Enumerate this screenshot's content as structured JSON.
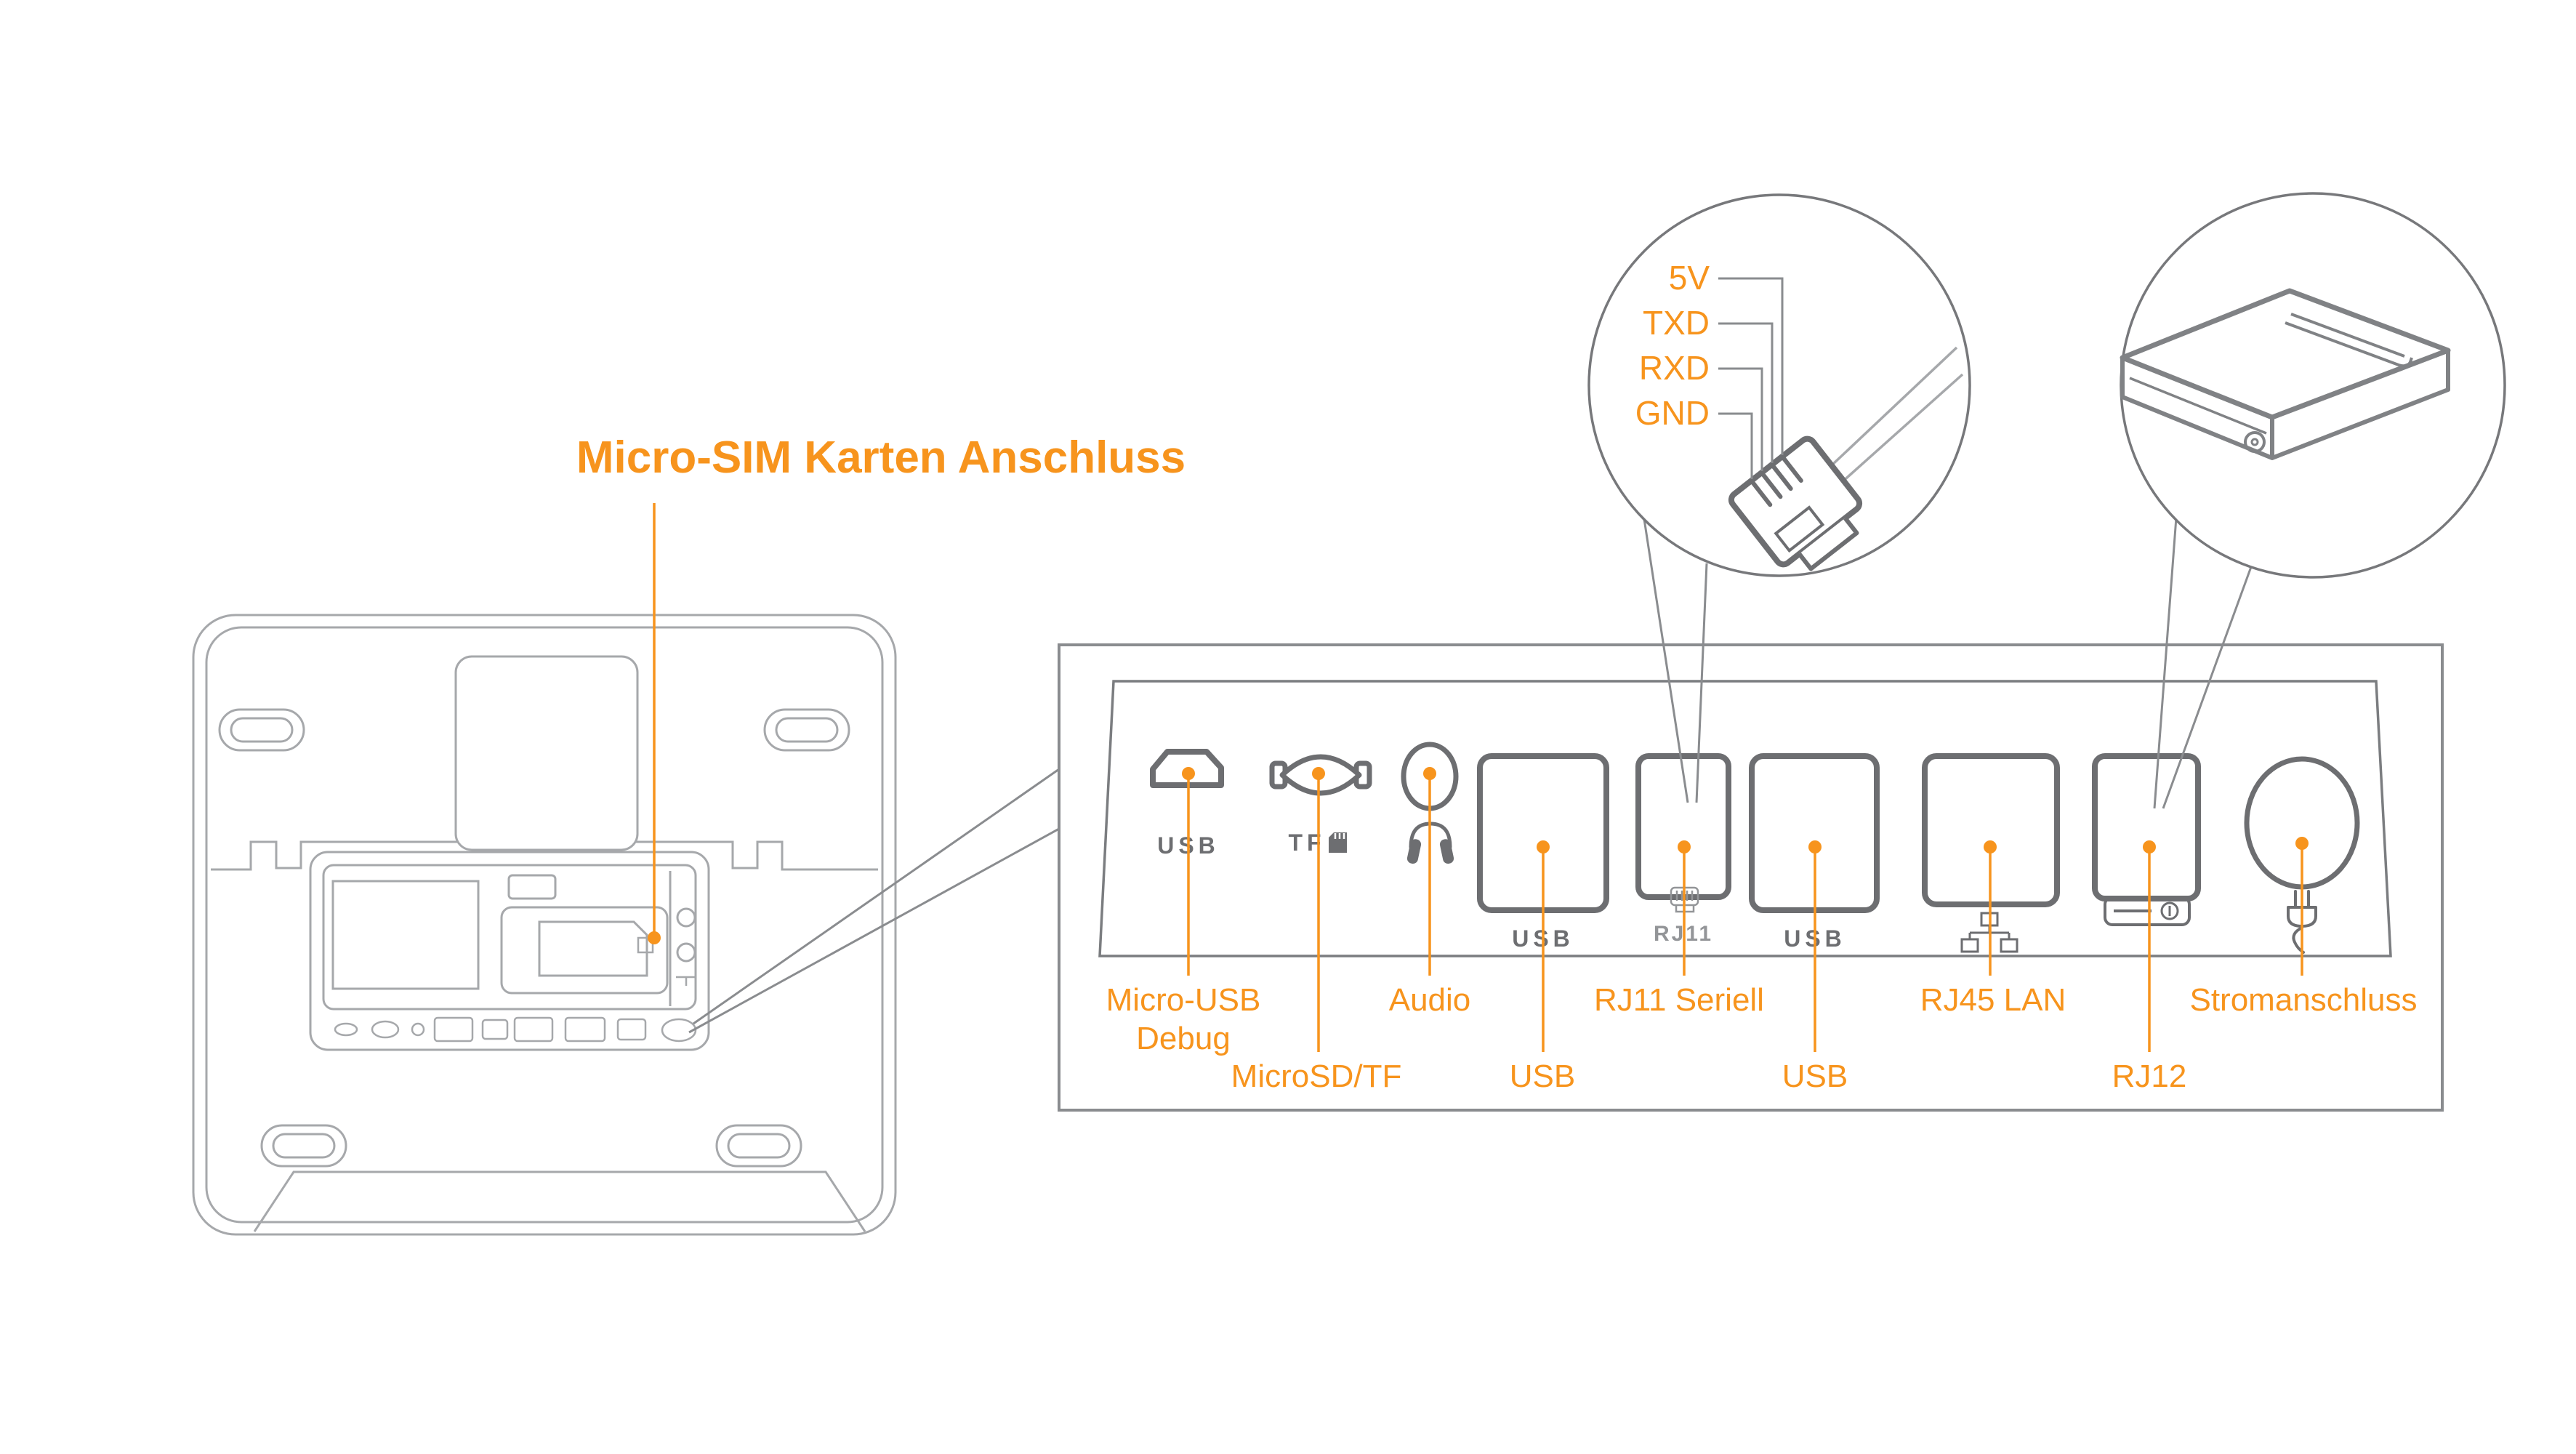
{
  "title": "Micro-SIM Karten Anschluss",
  "colors": {
    "accent": "#F7941D",
    "port_gray": "#6D6E71",
    "outline_gray": "#A6A8AB"
  },
  "rj11_callout": {
    "pins": [
      {
        "label": "5V"
      },
      {
        "label": "TXD"
      },
      {
        "label": "RXD"
      },
      {
        "label": "GND"
      }
    ]
  },
  "panel": {
    "engravings": {
      "micro_usb": "USB",
      "tf": "TF",
      "usb1": "USB",
      "rj11": "RJ11",
      "usb2": "USB"
    },
    "labels": {
      "micro_usb_line1": "Micro-USB",
      "micro_usb_line2": "Debug",
      "microsd": "MicroSD/TF",
      "audio": "Audio",
      "usb1": "USB",
      "rj11": "RJ11 Seriell",
      "usb2": "USB",
      "rj45": "RJ45 LAN",
      "rj12": "RJ12",
      "power": "Stromanschluss"
    }
  }
}
